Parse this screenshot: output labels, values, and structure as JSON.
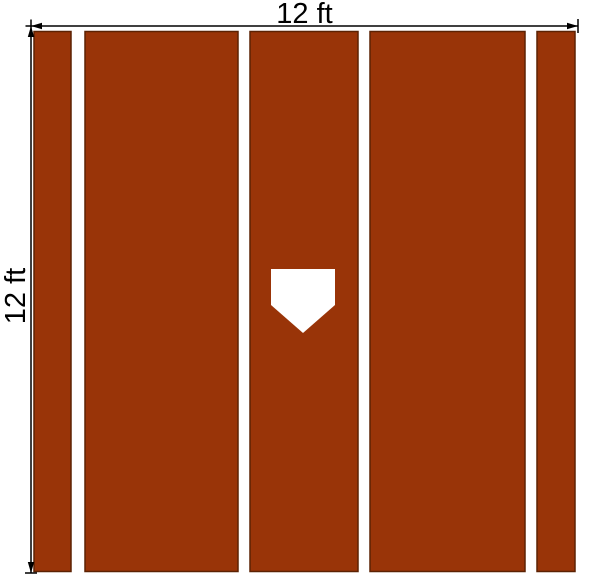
{
  "dimensions": {
    "width_label": "12 ft",
    "height_label": "12 ft"
  },
  "icons": {
    "home_plate": "home-plate-icon"
  },
  "colors": {
    "background": "#ffffff",
    "turf": "#993408",
    "turf_border": "#5c2203",
    "dimension_line": "#000000",
    "plate": "#ffffff"
  }
}
